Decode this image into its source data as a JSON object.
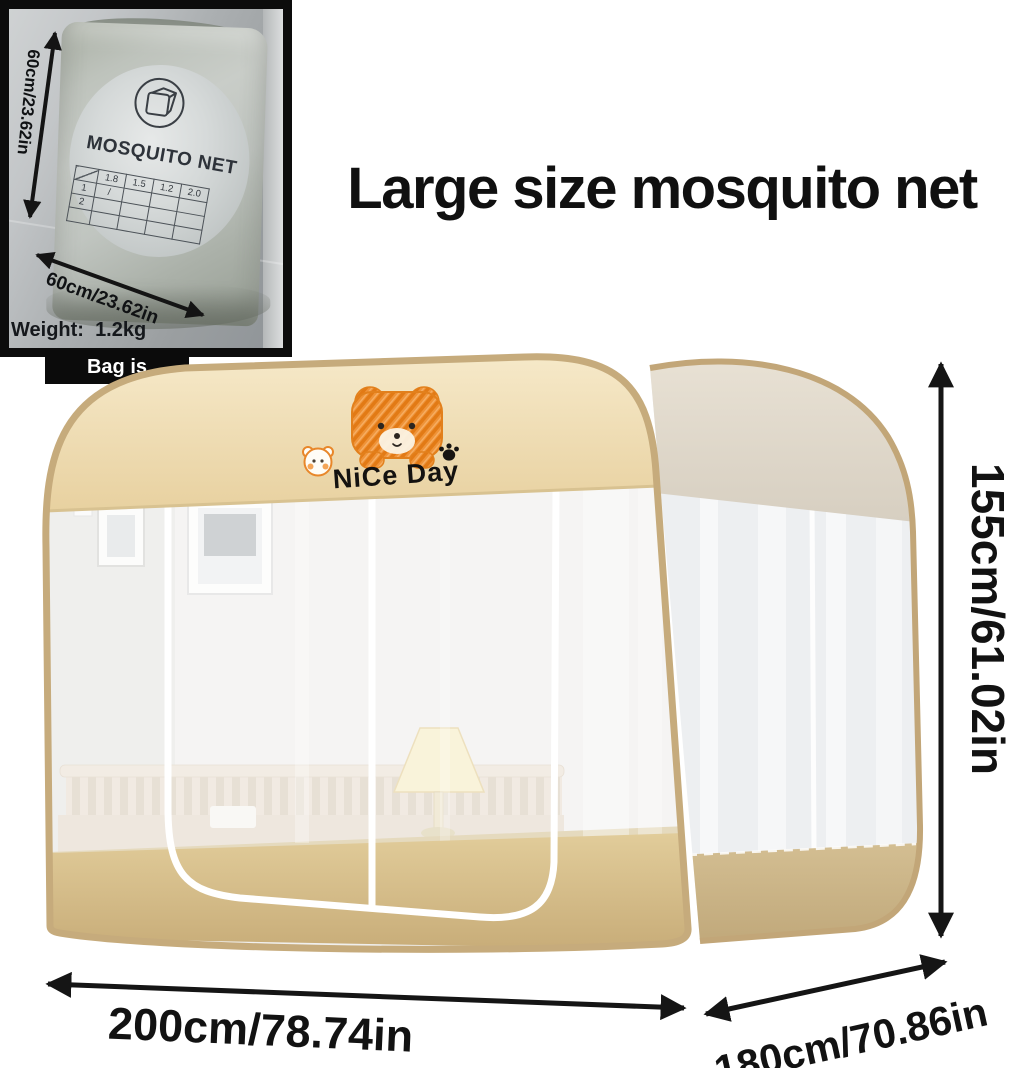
{
  "title": "Large size mosquito net",
  "photo": {
    "bag_title": "MOSQUITO NET",
    "side_dim": "60cm/23.62in",
    "bottom_dim": "60cm/23.62in",
    "weight": "Weight:  1.2kg",
    "badge": "Bag is included",
    "table": {
      "header": [
        "1.8",
        "1.5",
        "1.2",
        "2.0"
      ],
      "rows": [
        [
          "1",
          "/",
          "",
          "",
          ""
        ],
        [
          "2",
          "",
          "",
          "",
          ""
        ],
        [
          "",
          "",
          "",
          "",
          ""
        ]
      ]
    }
  },
  "tent": {
    "print_text": "NiCe Day"
  },
  "dimensions": {
    "height": "155cm/61.02in",
    "width": "200cm/78.74in",
    "depth": "180cm/70.86in"
  },
  "icons": {
    "bag_icon": "net-cube-in-circle",
    "bear_icon": "orange-doodle-bear",
    "small_bear_icon": "outlined-bear-face",
    "paw_icon": "paw-print"
  },
  "colors": {
    "accent_orange": "#e8861f",
    "tent_band": "#f0dfb9",
    "tent_skirt": "#d3bc8b",
    "piping_tan": "#c6ab7c",
    "arrow_black": "#151515"
  }
}
